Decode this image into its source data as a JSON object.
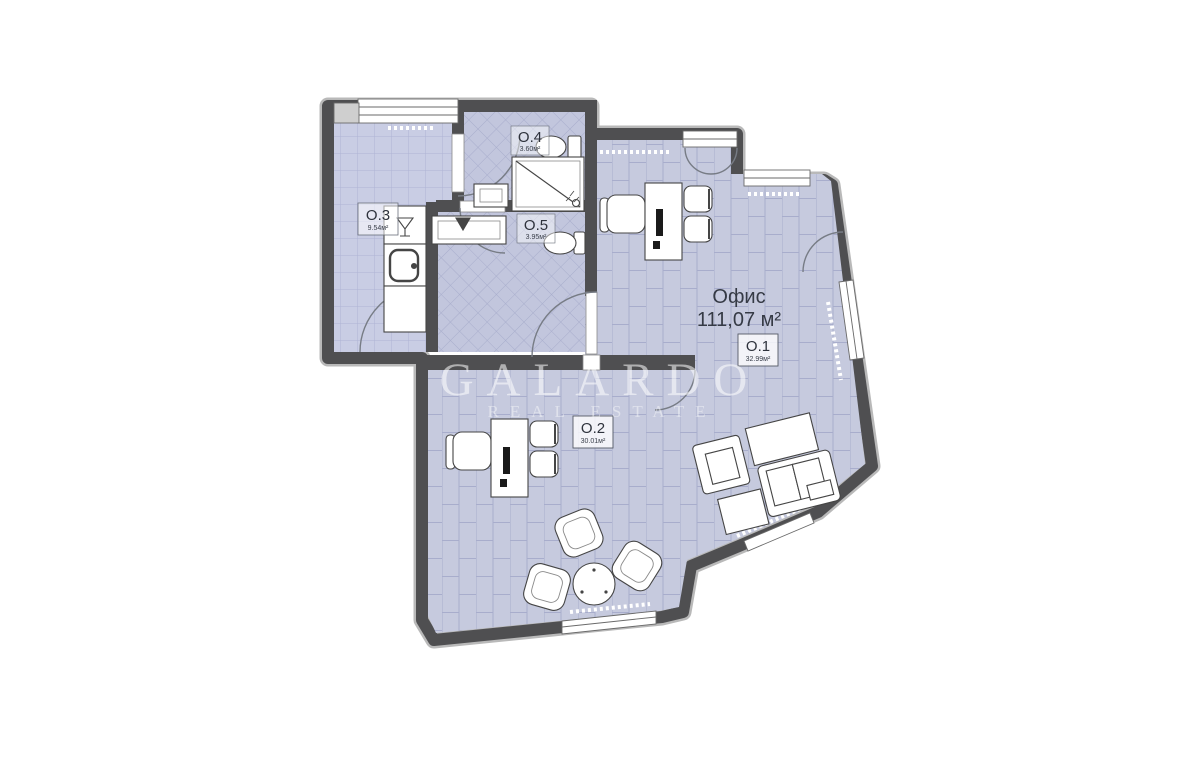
{
  "floor_plan": {
    "title": {
      "label": "Офис",
      "area": "111,07 м²"
    },
    "rooms": [
      {
        "id": "O.1",
        "area": "32.99м²"
      },
      {
        "id": "O.2",
        "area": "30.01м²"
      },
      {
        "id": "O.3",
        "area": "9.54м²"
      },
      {
        "id": "O.4",
        "area": "3.60м²"
      },
      {
        "id": "O.5",
        "area": "3.95м²"
      }
    ],
    "watermark": {
      "brand": "GALARDO",
      "tagline": "REAL ESTATE"
    },
    "colors": {
      "wall": "#4f4f51",
      "wall_outer_edge": "#b9b9b9",
      "floor_tile": "#c6cade",
      "tile_joint": "#a8adcc",
      "furniture_fill": "#ffffff",
      "furniture_outline": "#454545",
      "label_text": "#2e323c",
      "watermark": "#ffffff"
    }
  }
}
